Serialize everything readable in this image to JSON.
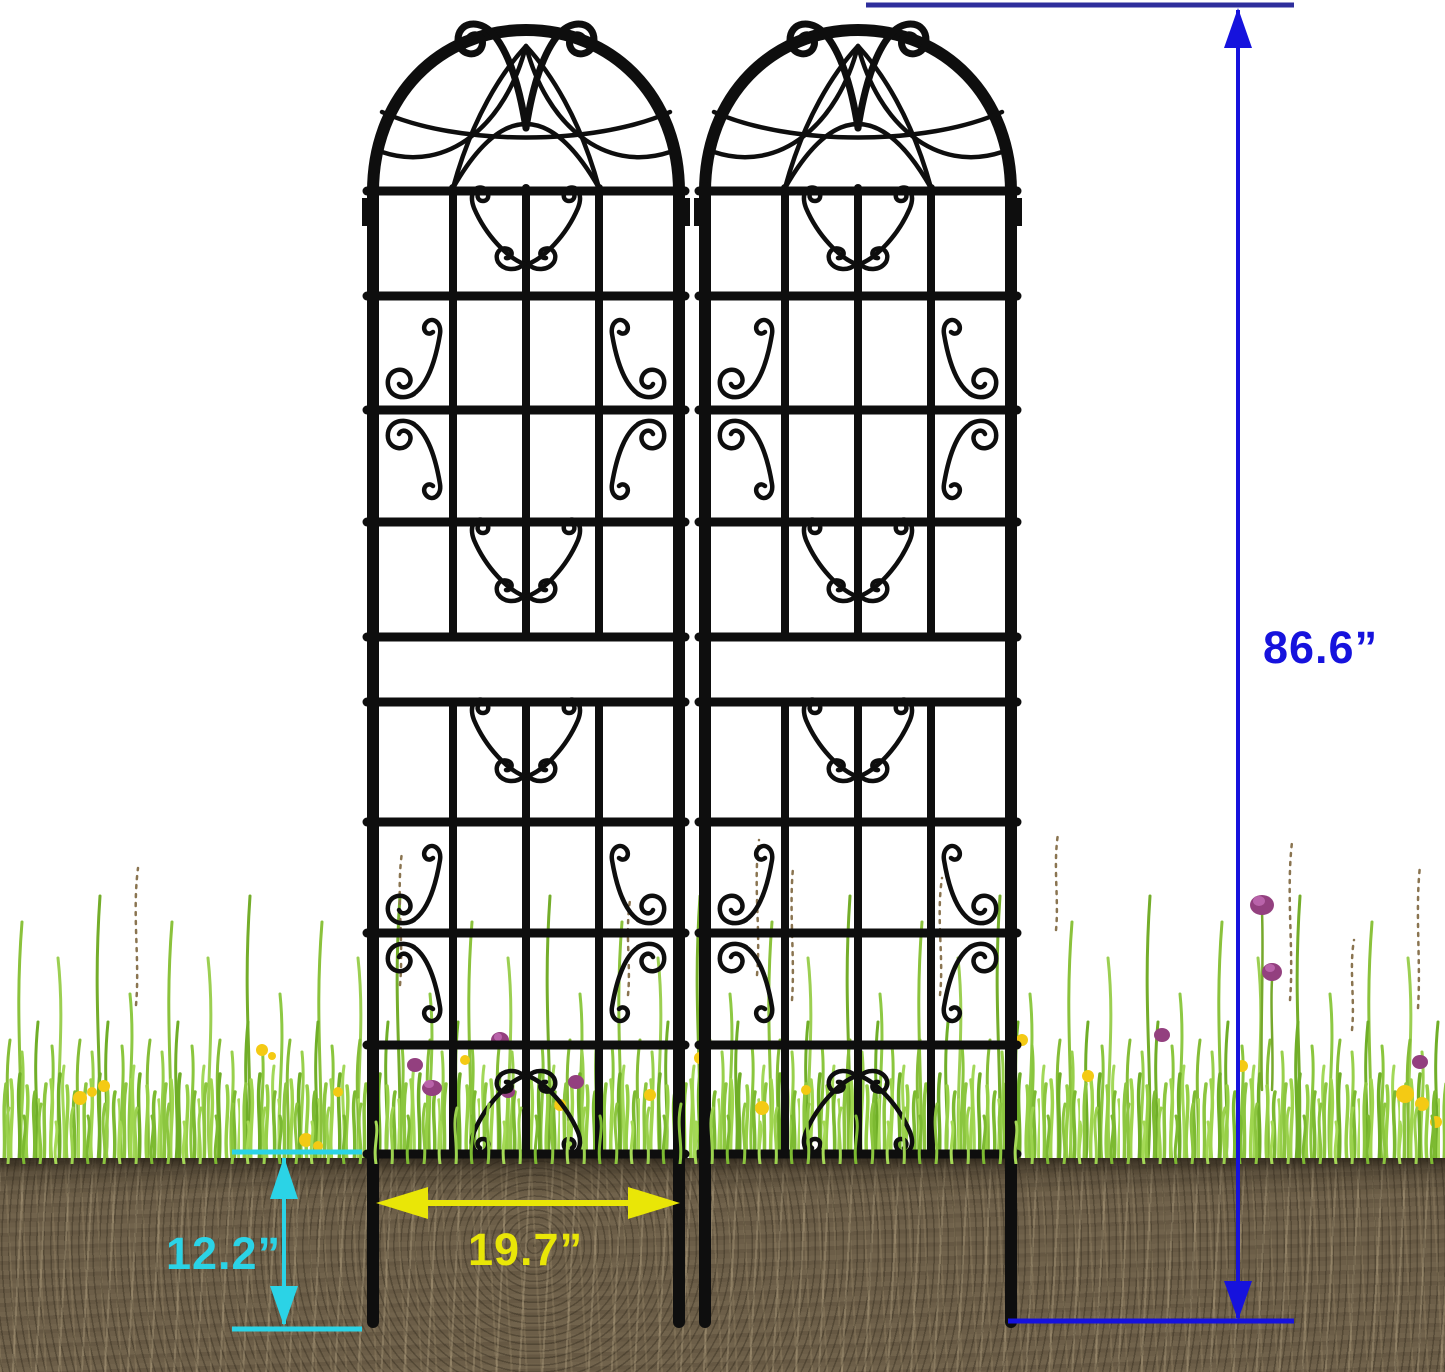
{
  "scene": {
    "trellis_count": 2
  },
  "dimensions": {
    "height": {
      "value": "86.6”"
    },
    "depth": {
      "value": "12.2”"
    },
    "width": {
      "value": "19.7”"
    }
  },
  "colors": {
    "height_accent": "#1612dd",
    "height_line": "#2e2e9c",
    "depth_accent": "#2bd3e6",
    "width_accent": "#e9e607",
    "trellis": "#0e0e0e",
    "soil": "#6a5c46",
    "grass_light": "#9cd455",
    "grass_dark": "#6fae27"
  }
}
